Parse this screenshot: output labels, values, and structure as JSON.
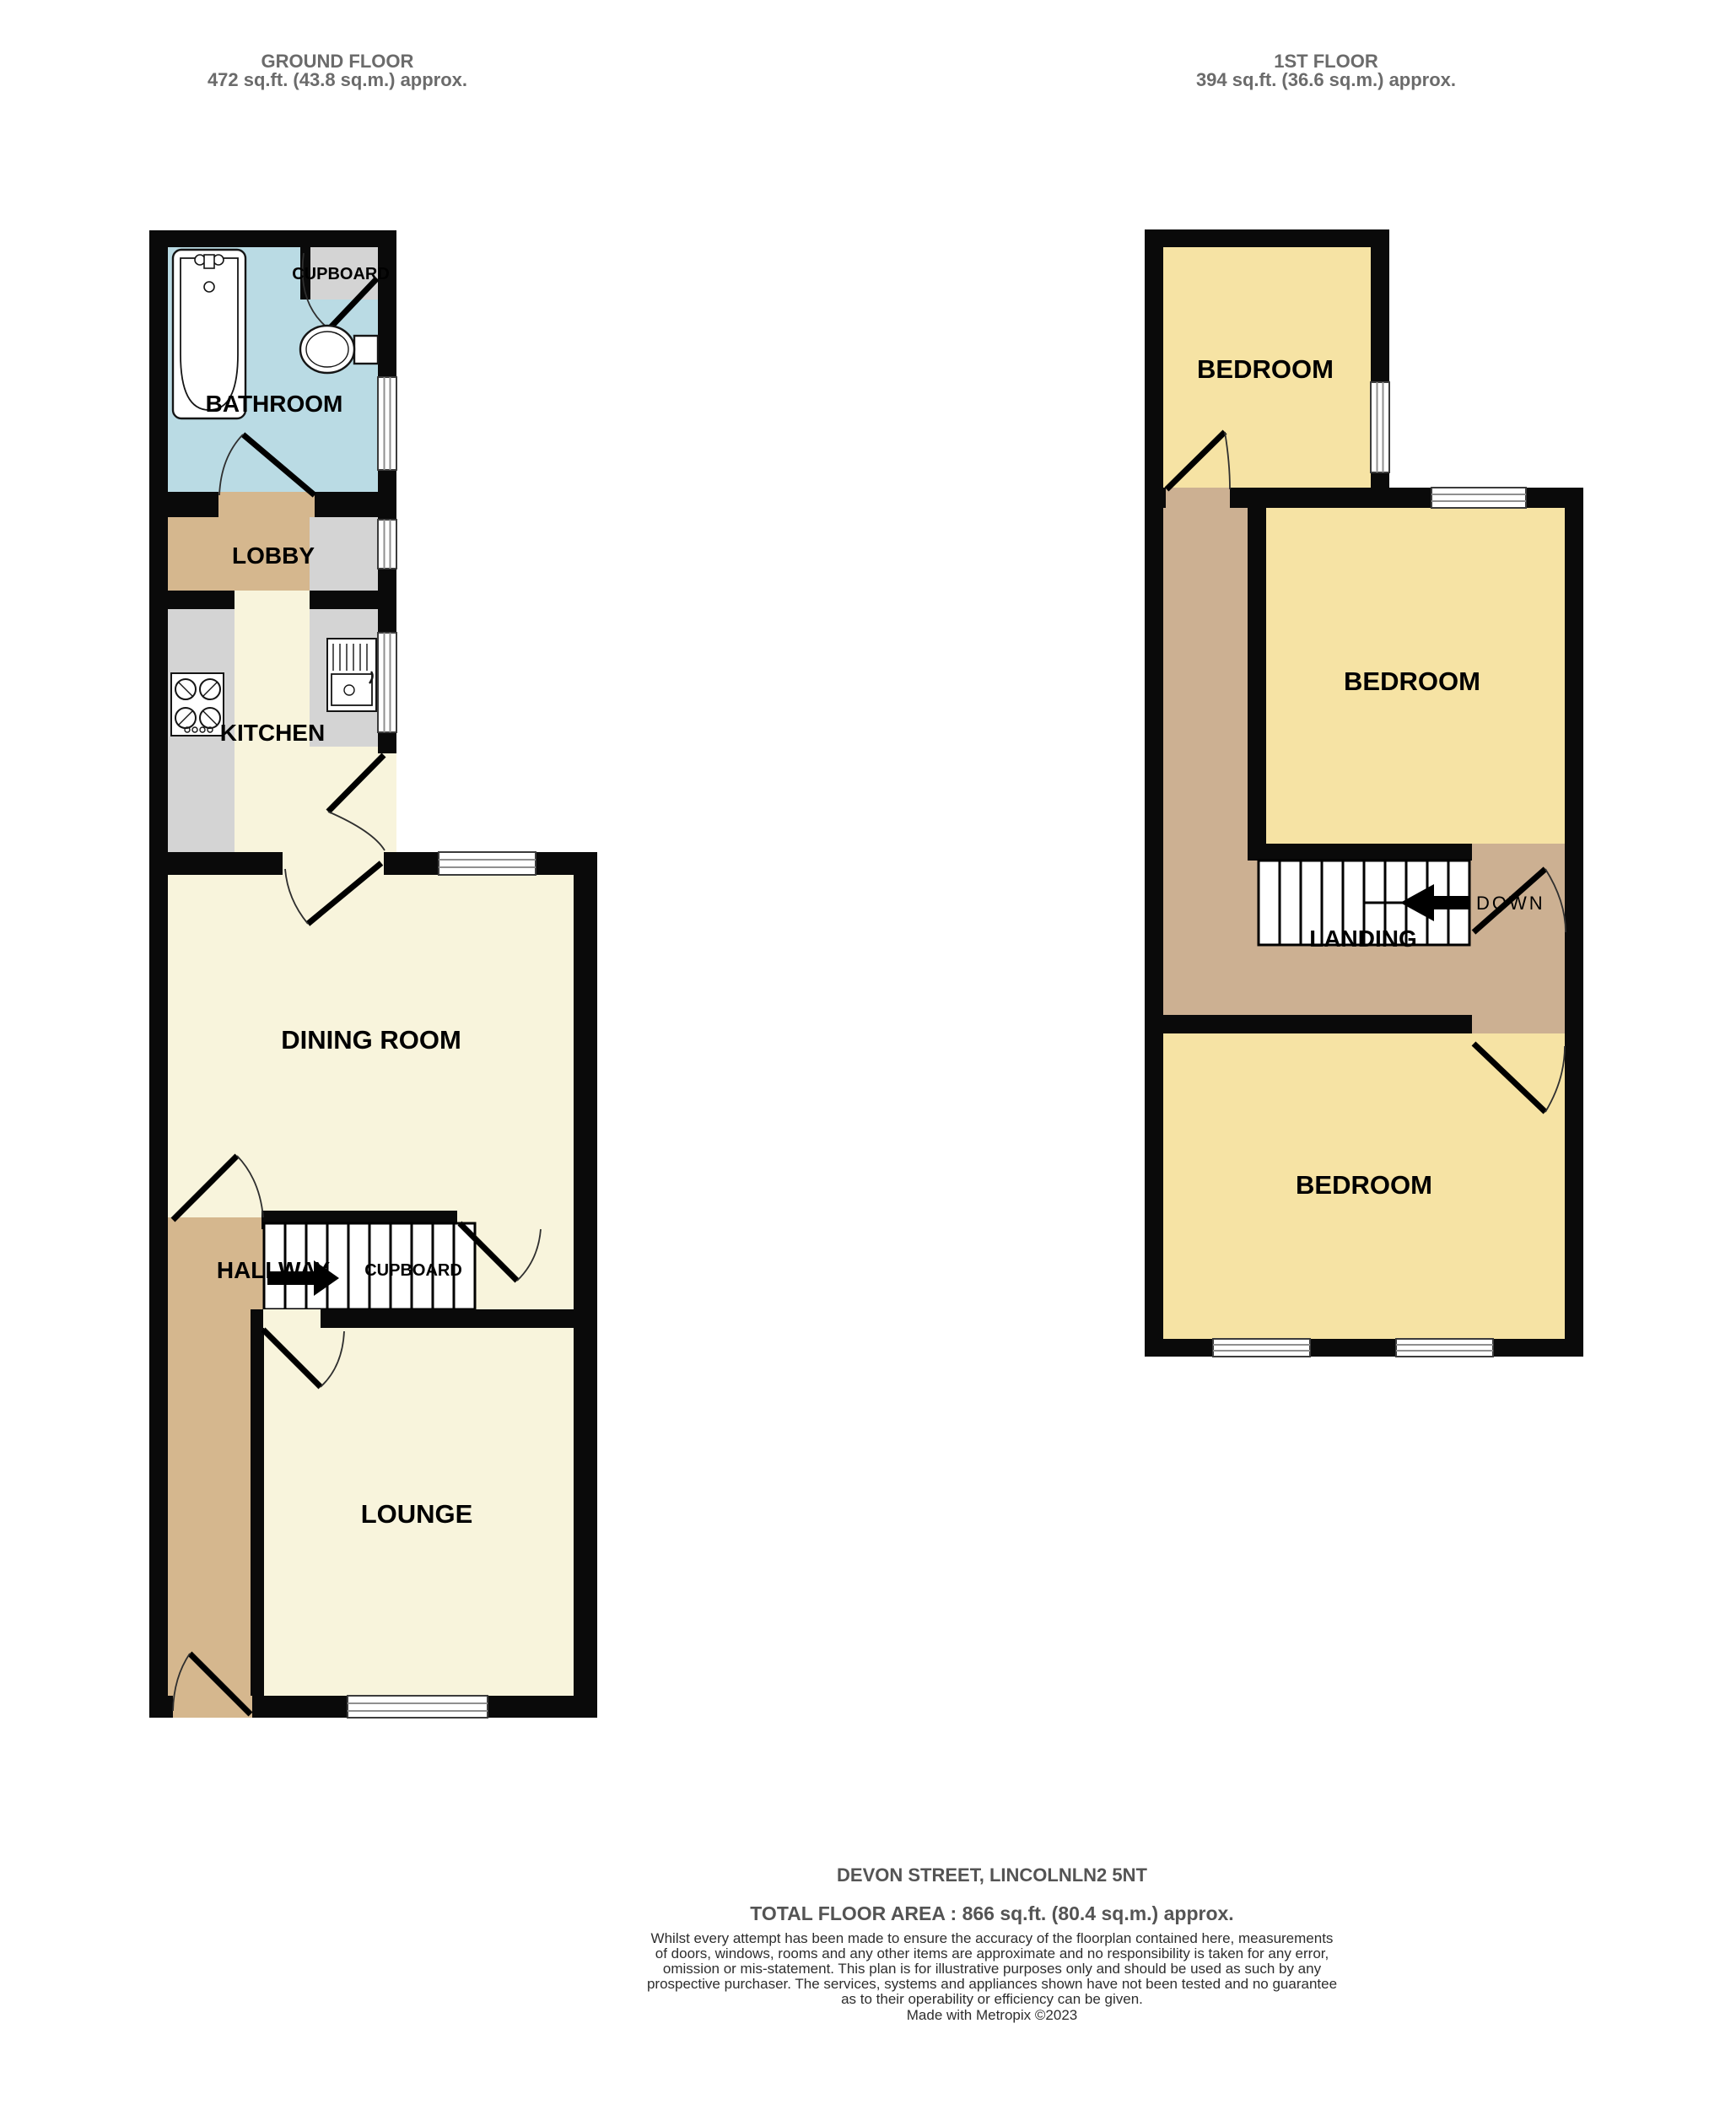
{
  "headers": {
    "ground": {
      "title": "GROUND FLOOR",
      "area": "472 sq.ft. (43.8 sq.m.) approx."
    },
    "first": {
      "title": "1ST FLOOR",
      "area": "394 sq.ft. (36.6 sq.m.) approx."
    }
  },
  "ground_floor": {
    "bathroom_label": "BATHROOM",
    "cupboard_label": "CUPBOARD",
    "lobby_label": "LOBBY",
    "kitchen_label": "KITCHEN",
    "dining_label": "DINING ROOM",
    "hallway_label": "HALLWAY",
    "stairs_cupboard_label": "CUPBOARD",
    "lounge_label": "LOUNGE"
  },
  "first_floor": {
    "bedroom_top_label": "BEDROOM",
    "bedroom_middle_label": "BEDROOM",
    "landing_label": "LANDING",
    "down_label": "DOWN",
    "bedroom_bottom_label": "BEDROOM"
  },
  "footer": {
    "address": "DEVON STREET, LINCOLNLN2 5NT",
    "total_area": "TOTAL FLOOR AREA : 866 sq.ft. (80.4 sq.m.) approx.",
    "disclaimer_lines": [
      "Whilst every attempt has been made to ensure the accuracy of the floorplan contained here, measurements",
      "of doors, windows, rooms and any other items are approximate and no responsibility is taken for any error,",
      "omission or mis-statement. This plan is for illustrative purposes only and should be used as such by any",
      "prospective purchaser. The services, systems and appliances shown have not been tested and no guarantee",
      "as to their operability or efficiency can be given."
    ],
    "credit": "Made with Metropix ©2023"
  },
  "colors": {
    "wall": "#0a0a0a",
    "cream": "#f8f4dc",
    "bedroom_yellow": "#f6e3a4",
    "tan": "#d5b78e",
    "landing_tan": "#ccb092",
    "bathroom_blue": "#badbe4",
    "counter_gray": "#d4d4d4",
    "header_text": "#6b6b6b",
    "footer_text": "#545454",
    "disclaimer_text": "#2e2e2e"
  }
}
